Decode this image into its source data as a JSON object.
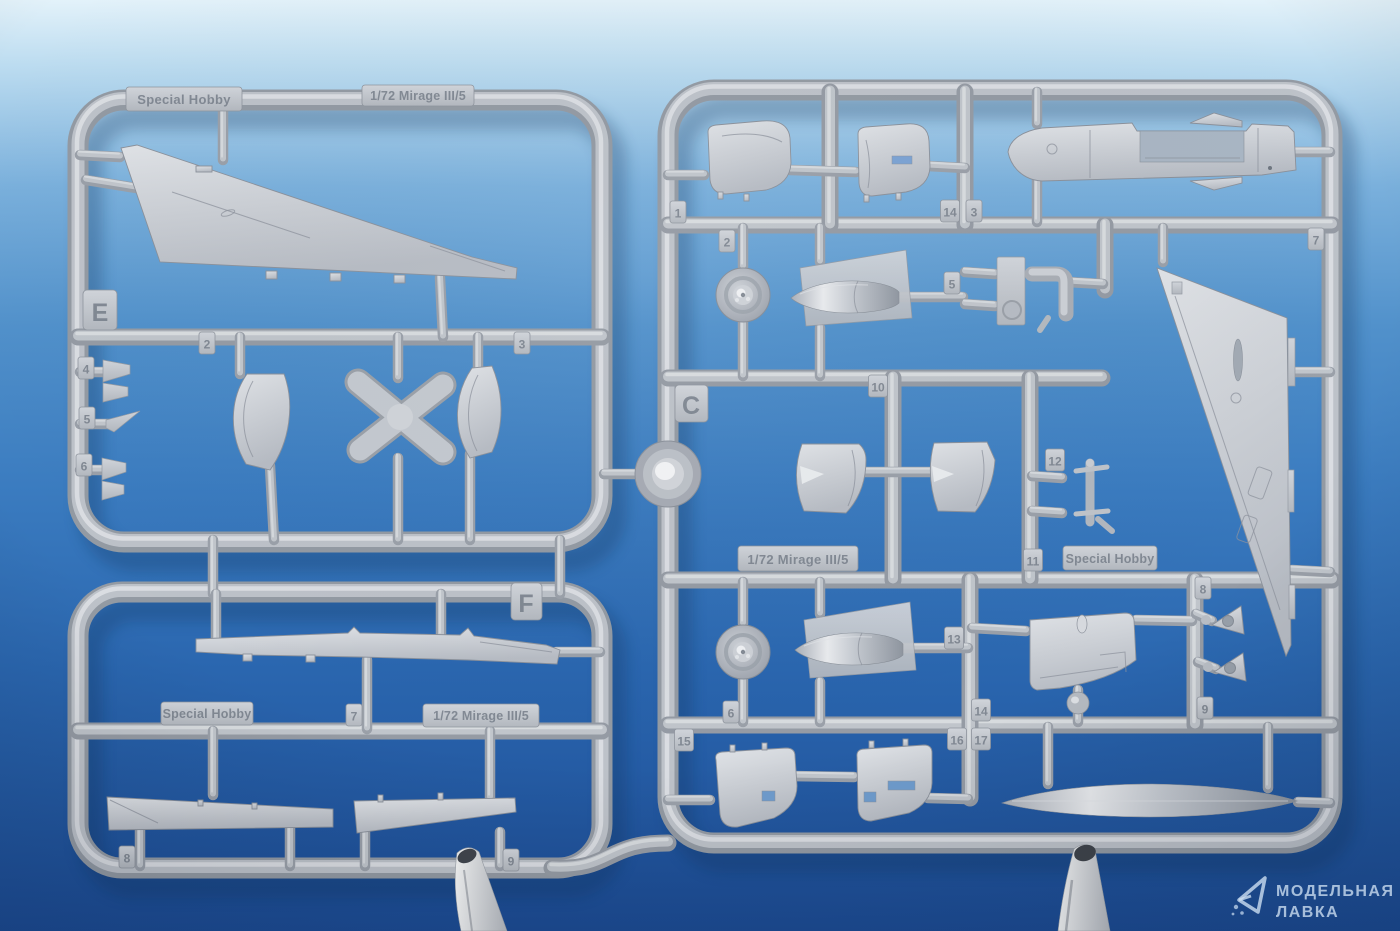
{
  "colors": {
    "background_top": "#ddeef8",
    "background_mid": "#3b7cc0",
    "background_bottom": "#1c4b93",
    "plastic": "#bcc1c9",
    "plastic_highlight": "#dde0e4",
    "plastic_shadow": "#939aa3",
    "bright_part": "#f4f5f6",
    "watermark_text": "#cfe1f3"
  },
  "left_sprue": {
    "letter_top": "E",
    "letter_bottom": "F",
    "brand_top": "Special Hobby",
    "title_top": "1/72 Mirage III/5",
    "brand_bottom": "Special Hobby",
    "title_bottom": "1/72 Mirage III/5",
    "part_tags": {
      "t2": "2",
      "t3": "3",
      "t4": "4",
      "t5": "5",
      "t6": "6",
      "t7": "7",
      "t8": "8",
      "t9": "9"
    }
  },
  "right_sprue": {
    "letter": "C",
    "brand": "Special Hobby",
    "title": "1/72 Mirage III/5",
    "part_tags": {
      "t1": "1",
      "t2": "2",
      "t3": "3",
      "t5": "5",
      "t6": "6",
      "t7": "7",
      "t8": "8",
      "t9": "9",
      "t10": "10",
      "t11": "11",
      "t12": "12",
      "t13": "13",
      "t14a": "14",
      "t14b": "14",
      "t15": "15",
      "t16": "16",
      "t17": "17"
    }
  },
  "watermark": {
    "line1": "МОДЕЛЬНАЯ",
    "line2": "ЛАВКА"
  }
}
